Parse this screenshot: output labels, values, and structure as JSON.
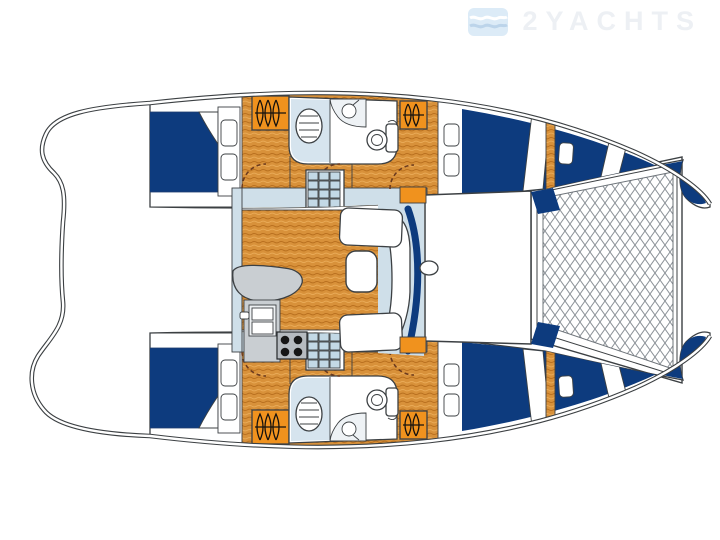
{
  "watermark": {
    "brand": "2YACHTS",
    "icon": "waves-flag-logo"
  },
  "diagram": {
    "type": "catamaran-floor-plan"
  },
  "palette": {
    "background": "#ffffff",
    "berth_navy": "#0d3b7e",
    "wood_orange": "#d8913a",
    "wood_grain_dark": "#b9701f",
    "wood_grain_light": "#e9aa57",
    "hatch_orange": "#f0921e",
    "wall_light_blue": "#cfdfe9",
    "stair_blue": "#c3d9e6",
    "counter_gray": "#c9ced2",
    "stove_gray": "#b6bbc0",
    "outline": "#3c4043",
    "net_line": "#8c9298",
    "door_arc": "#6b3a1e"
  }
}
